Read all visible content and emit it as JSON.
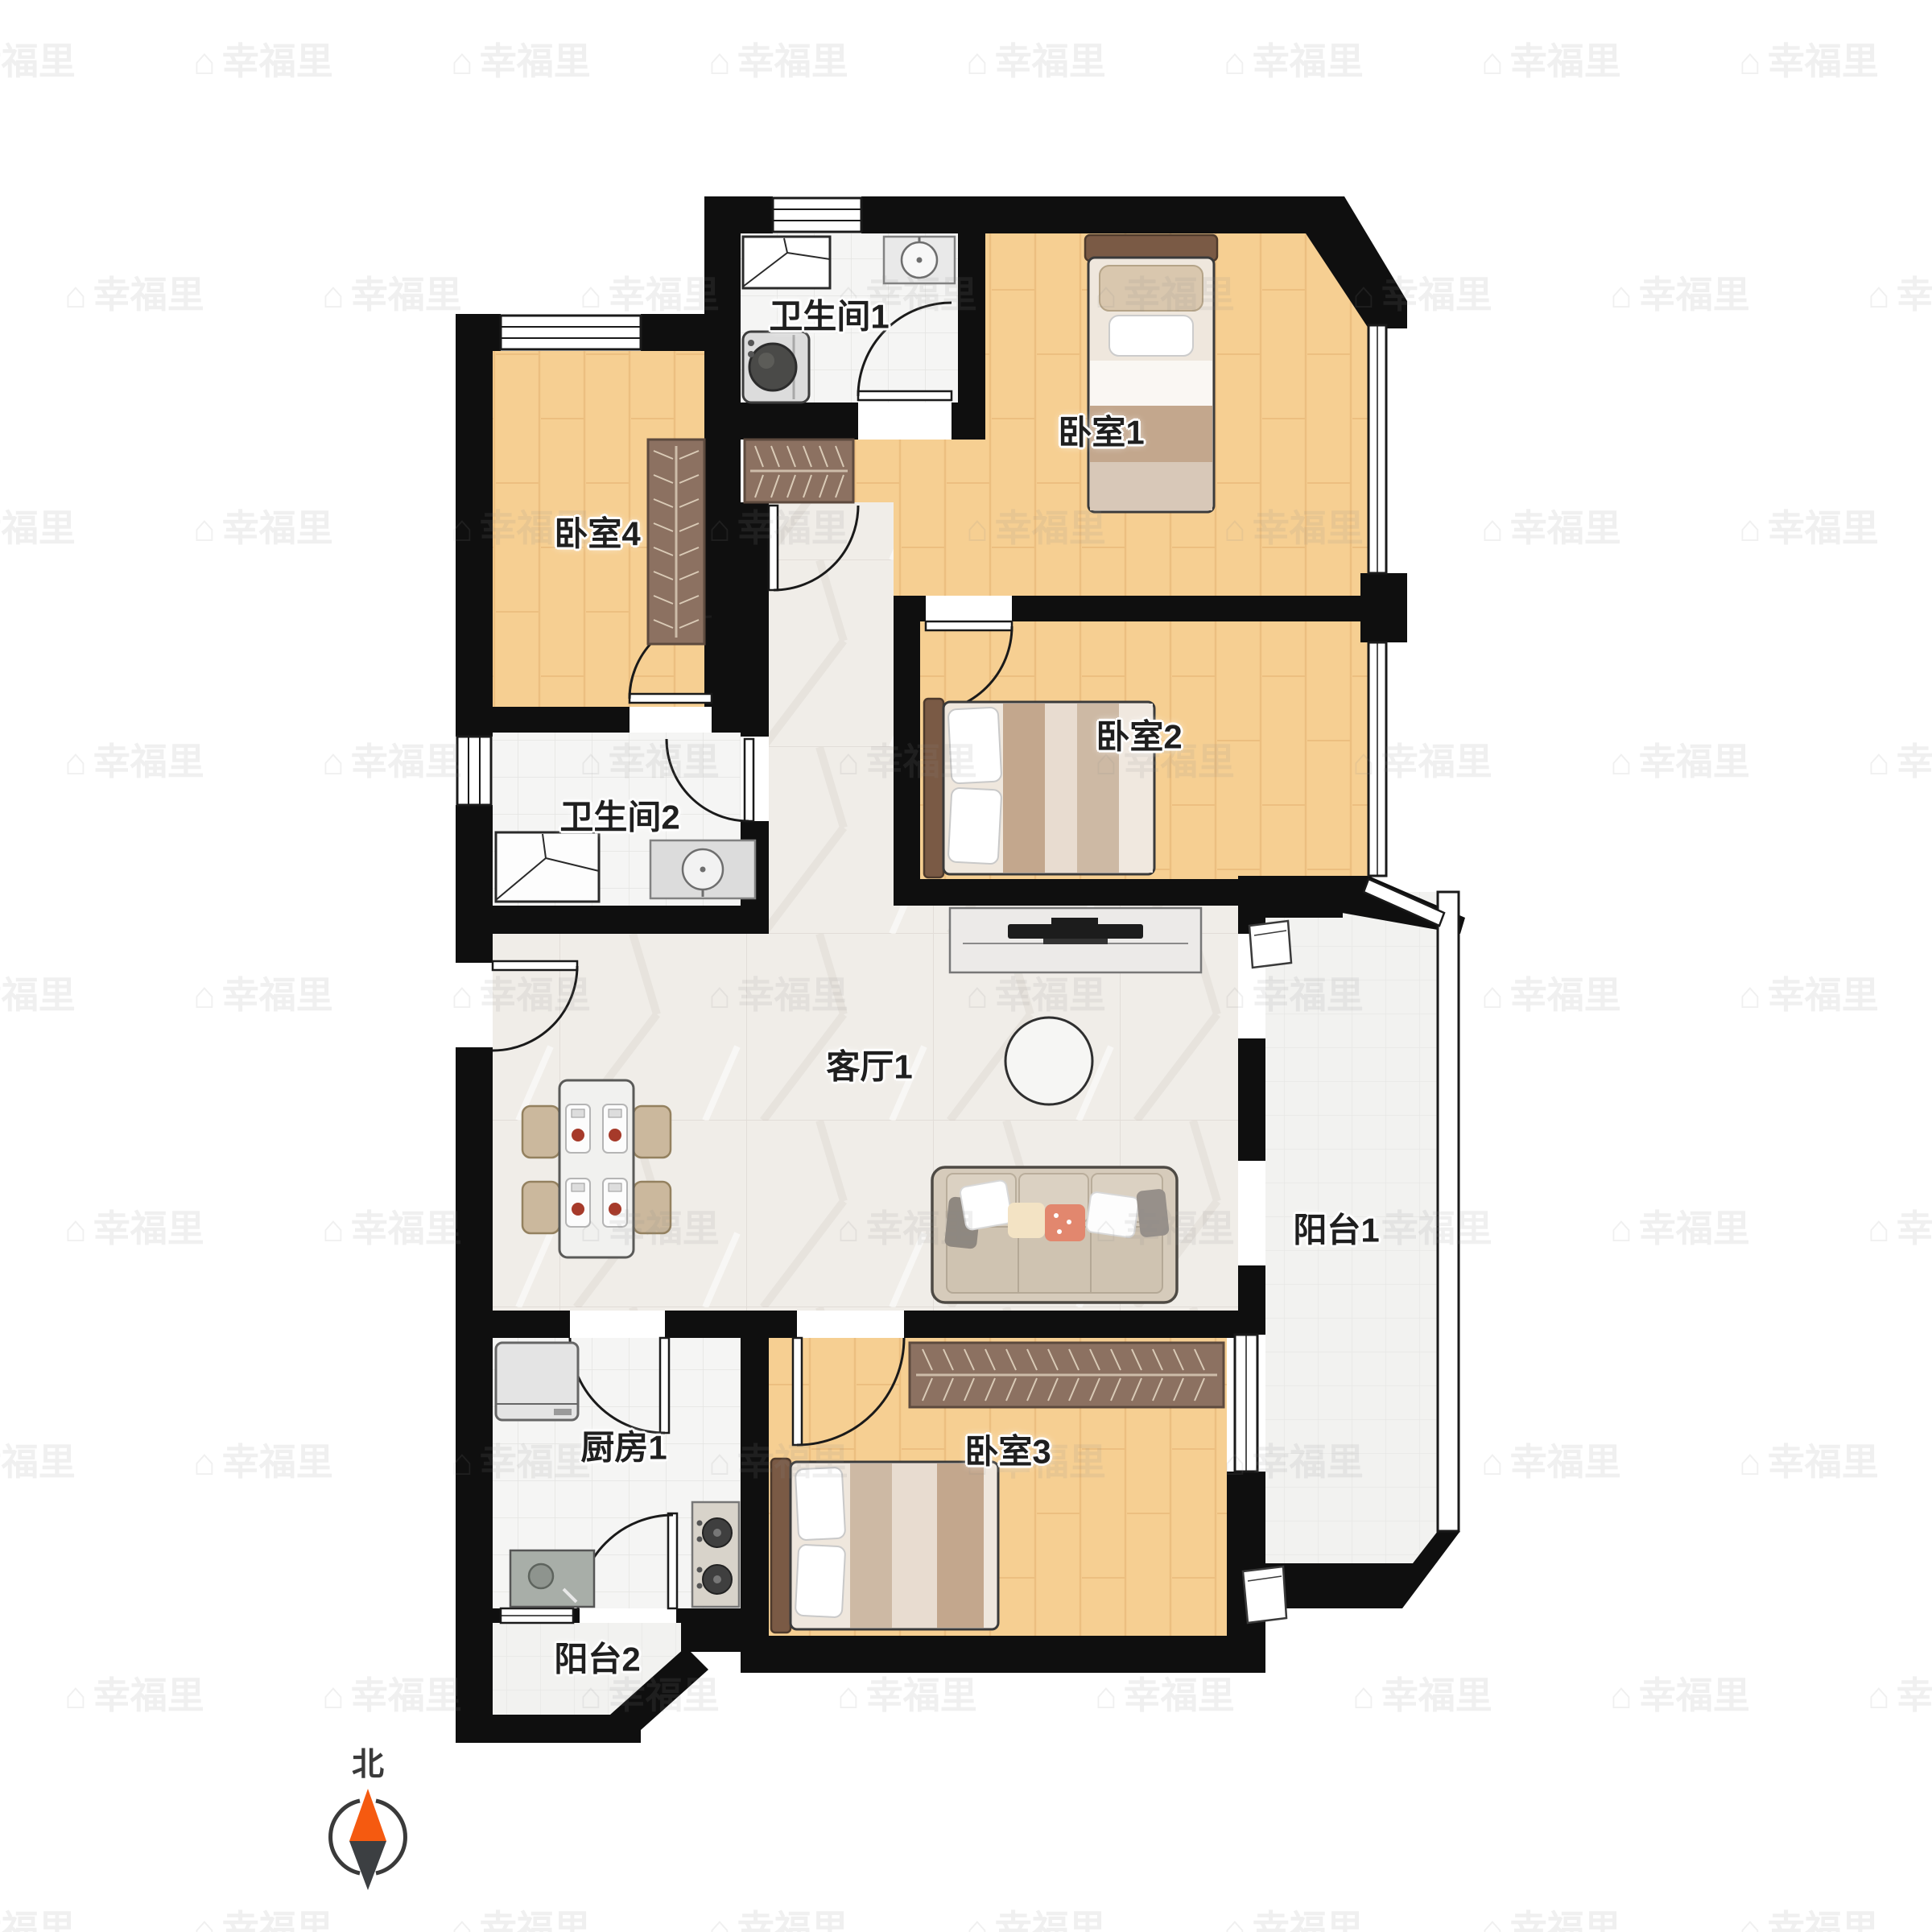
{
  "title": "户型图",
  "watermark": {
    "text": "幸福里",
    "icon": "house-icon"
  },
  "compass": {
    "label": "北"
  },
  "rooms": {
    "bathroom1": {
      "label": "卫生间1"
    },
    "bedroom1": {
      "label": "卧室1"
    },
    "bedroom4": {
      "label": "卧室4"
    },
    "bathroom2": {
      "label": "卫生间2"
    },
    "bedroom2": {
      "label": "卧室2"
    },
    "living": {
      "label": "客厅1"
    },
    "balcony1": {
      "label": "阳台1"
    },
    "kitchen": {
      "label": "厨房1"
    },
    "bedroom3": {
      "label": "卧室3"
    },
    "balcony2": {
      "label": "阳台2"
    }
  },
  "colors": {
    "wall": "#0f0f0f",
    "wood_floor": "#f6cf92",
    "marble_floor": "#f0ede8",
    "tile_floor": "#f5f5f4",
    "wardrobe": "#8c7161",
    "bed_headboard": "#7a5a45",
    "compass_north": "#f55a10"
  }
}
